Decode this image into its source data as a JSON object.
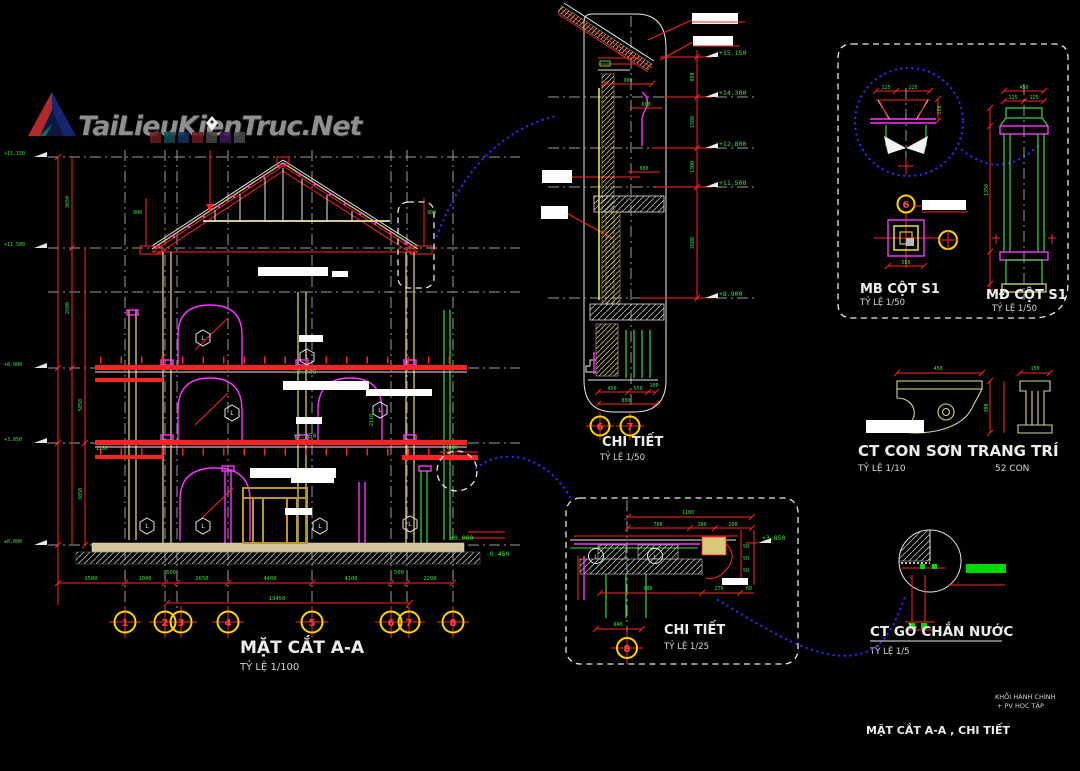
{
  "colors": {
    "background": "#000000",
    "dimension_red": "#ff2222",
    "dimension_text_green": "#35e835",
    "profile_magenta": "#ff33ff",
    "structure_khaki": "#c9bd72",
    "slab_tan": "#d2c49c",
    "grid_gray": "#9a9a9a",
    "callout_blue": "#2d2dff",
    "bubble_yellow": "#ffd500",
    "text_white": "#ededed",
    "highlight_green": "#00d800"
  },
  "logo": {
    "text": "TaiLieuKienTruc.Net"
  },
  "section": {
    "title": "MẶT CẮT A-A",
    "scale": "TỶ LỆ 1/100",
    "grid_bubbles": [
      "1",
      "2",
      "3",
      "4",
      "5",
      "6",
      "7",
      "8"
    ],
    "dims_bottom": [
      "1500",
      "1000",
      "600",
      "2650",
      "4400",
      "4100",
      "500",
      "2200"
    ],
    "dim_total": "13450",
    "dims_left": [
      "3650",
      "2600",
      "5050",
      "3850"
    ],
    "dim_right": "2110",
    "eave_dim": "900",
    "balcony_dim": "1180",
    "hex_mark": "L",
    "levels": {
      "ridge": "+15.150",
      "eave": "+11.500",
      "floor3": "+8.900",
      "floor2": "+3.850",
      "ground": "±0.000",
      "sidewalk": "-0.450"
    }
  },
  "detail_top": {
    "title": "CHI TIẾT",
    "scale": "TỶ LỆ 1/50",
    "bubbles": [
      "6",
      "7"
    ],
    "levels": [
      "+15.150",
      "+14.300",
      "+12.800",
      "+11.500",
      "+8.900"
    ],
    "right_dims": [
      "850",
      "1500",
      "1300",
      "2600"
    ],
    "dims": {
      "overhang": "900",
      "parapet": "600",
      "band": "600",
      "c1": "450",
      "c2": "550",
      "c3": "100",
      "total": "800"
    }
  },
  "cot_details": {
    "mb": {
      "title": "MB CỘT S1",
      "scale": "TỶ LỆ 1/50",
      "dim_bottom": "550"
    },
    "md": {
      "title": "MĐ CỘT S1",
      "scale": "TỶ LỆ 1/50",
      "dim_top": "450",
      "dim_halves": "125",
      "dim_shaft": "1350"
    },
    "cap": {
      "dim_a": "125",
      "dim_b": "225",
      "dim_c": "150"
    }
  },
  "conson": {
    "title": "CT CON SƠN TRANG TRÍ",
    "scale": "TỶ LỆ 1/10",
    "count": "52 CON",
    "dim_w1": "450",
    "dim_w2": "150",
    "dim_h": "300"
  },
  "go_chan_nuoc": {
    "title": "CT GỜ CHẮN NƯỚC",
    "scale": "TỶ LỆ 1/5"
  },
  "detail_low": {
    "title": "CHI TIẾT",
    "scale": "TỶ LỆ 1/25",
    "bubble": "8",
    "level": "+3.850",
    "dims": {
      "total": "1180",
      "a": "700",
      "b": "280",
      "c": "200",
      "span": "900",
      "d": "270",
      "e": "60",
      "f": "640",
      "g": "50"
    }
  },
  "titleblock": {
    "block_line1": "KHỐI HÀNH CHÍNH",
    "block_line2": "+ PV HỌC TẬP",
    "sheet_title": "MẶT CẮT A-A , CHI TIẾT"
  }
}
